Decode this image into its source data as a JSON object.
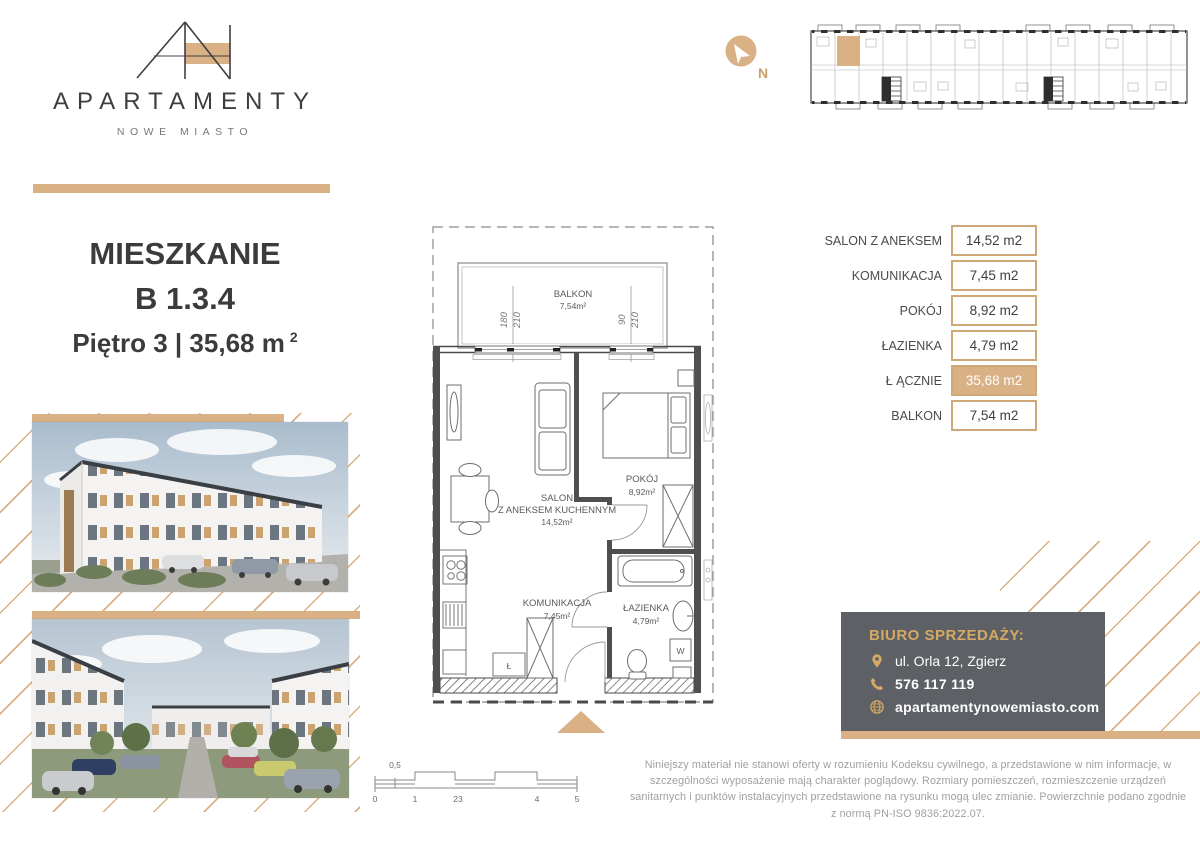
{
  "logo": {
    "brand": "APARTAMENTY",
    "sub": "NOWE MIASTO"
  },
  "title": {
    "line1": "MIESZKANIE",
    "line2": "B 1.3.4",
    "line3": "Piętro 3 | 35,68 m",
    "superscript": "2"
  },
  "compass": {
    "north": "N"
  },
  "colors": {
    "gold": "#d9b185",
    "box_gray": "#5d6064",
    "text_dark": "#3b3b3b"
  },
  "plan": {
    "balkon": {
      "name": "BALKON",
      "area": "7,54m²"
    },
    "salon": {
      "name1": "SALON",
      "name2": "Z ANEKSEM KUCHENNYM",
      "area": "14,52m²"
    },
    "pokoj": {
      "name": "POKÓJ",
      "area": "8,92m²"
    },
    "komunikacja": {
      "name": "KOMUNIKACJA",
      "area": "7,45m²"
    },
    "lazienka": {
      "name": "ŁAZIENKA",
      "area": "4,79m²"
    },
    "washer": "W",
    "storage": "Ł",
    "window1": {
      "w": "180",
      "h": "210"
    },
    "window2": {
      "w": "90",
      "h": "210"
    }
  },
  "areas_table": {
    "rows": [
      {
        "label": "SALON Z ANEKSEM",
        "value": "14,52 m2"
      },
      {
        "label": "KOMUNIKACJA",
        "value": "7,45 m2"
      },
      {
        "label": "POKÓJ",
        "value": "8,92 m2"
      },
      {
        "label": "ŁAZIENKA",
        "value": "4,79 m2"
      },
      {
        "label": "Ł ĄCZNIE",
        "value": "35,68 m2"
      },
      {
        "label": "BALKON",
        "value": "7,54 m2"
      }
    ]
  },
  "contact": {
    "heading": "BIURO SPRZEDAŻY:",
    "address": "ul. Orla 12, Zgierz",
    "phone": "576 117 119",
    "website": "apartamentynowemiasto.com"
  },
  "scalebar": {
    "half": "0,5",
    "t0": "0",
    "t1": "1",
    "t23": "23",
    "t4": "4",
    "t5": "5"
  },
  "disclaimer": "Niniejszy materiał nie stanowi oferty w rozumieniu Kodeksu cywilnego, a przedstawione w nim informacje, w szczególności wyposażenie mają charakter poglądowy. Rozmiary pomieszczeń, rozmieszczenie urządzeń sanitarnych i punktów instalacyjnych przedstawione na rysunku mogą ulec zmianie. Powierzchnie podano zgodnie z normą PN-ISO 9836:2022.07."
}
